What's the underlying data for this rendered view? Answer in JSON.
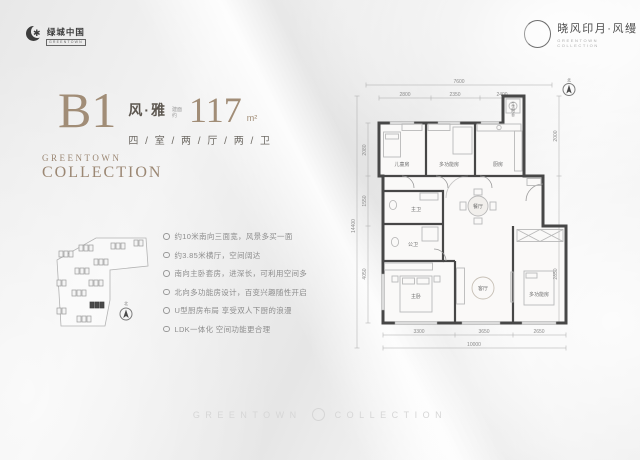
{
  "header": {
    "left_logo": {
      "name": "绿城中国",
      "sub": "GREENTOWN"
    },
    "right_logo": {
      "name": "晓风印月·风缦",
      "sub": "GREENTOWN COLLECTION"
    }
  },
  "title": {
    "code": "B1",
    "style_name": "风·雅",
    "area_label": "建面约",
    "area_value": "117",
    "area_unit": "m²",
    "spec": "四 / 室 / 两 / 厅 / 两 / 卫"
  },
  "collection": {
    "line1": "GREENTOWN",
    "line2": "COLLECTION"
  },
  "features": [
    "约10米南向三面宽，风景多买一面",
    "约3.85米横厅，空间阔达",
    "南向主卧套房，进深长，可利用空间多",
    "北向多功能房设计，百变兴趣随性开启",
    "U型厨房布局 享受双人下厨的浪漫",
    "LDK一体化 空间功能更合理"
  ],
  "floorplan": {
    "rooms": {
      "children_room": "儿童房",
      "multi_room_north": "多功能房",
      "kitchen": "厨房",
      "balcony": "生活阳台",
      "master_bath": "主卫",
      "guest_bath": "公卫",
      "dining": "餐厅",
      "living": "客厅",
      "master_bedroom": "主卧",
      "multi_room_south": "多功能房"
    },
    "dims": {
      "top_total": "7600",
      "top": [
        "2800",
        "2350",
        "2400"
      ],
      "left_total": "14400",
      "left": [
        "2080",
        "1550",
        "4050"
      ],
      "right": [
        "2000",
        "2850"
      ],
      "bottom": [
        "3300",
        "3650",
        "2650"
      ],
      "bottom_total": "10000"
    },
    "compass": "北"
  },
  "siteplan": {
    "compass": "北"
  },
  "watermark": {
    "left": "GREENTOWN",
    "right": "COLLECTION"
  }
}
